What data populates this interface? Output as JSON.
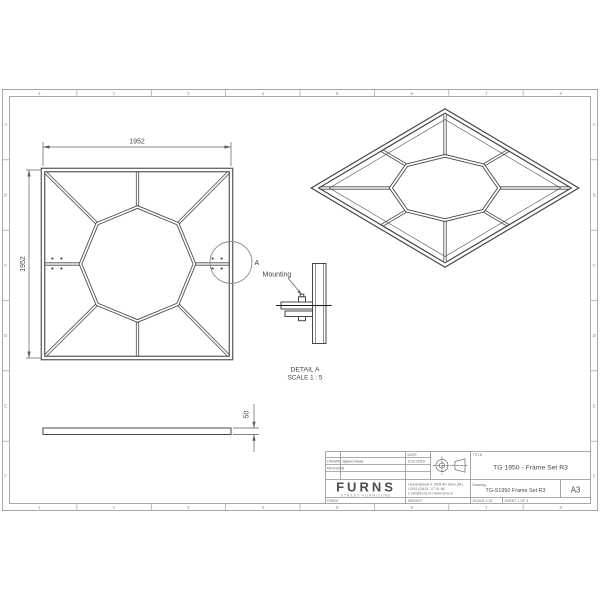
{
  "sheet": {
    "zone_columns": [
      "1",
      "2",
      "3",
      "4",
      "5",
      "6",
      "7",
      "8"
    ],
    "zone_rows": [
      "A",
      "B",
      "C",
      "D",
      "E",
      "F"
    ]
  },
  "front_view": {
    "width_dim": "1952",
    "height_dim": "1952",
    "detail_callout": "A"
  },
  "side_view": {
    "thickness_dim": "50"
  },
  "detail_view": {
    "mounting_label": "Mounting",
    "name": "DETAIL A",
    "scale": "SCALE 1 : 5"
  },
  "title_block": {
    "drawn_label": "DRAWN",
    "drawn_by": "Sjoerd Haas",
    "revision_label": "REVISION",
    "date_label": "DATE",
    "date_value": "3-12-2019",
    "title_label": "TITLE",
    "title_value": "TG 1950 - Frame Set R3",
    "logo_text": "FURNS",
    "logo_tagline": "STREET FURNITURE",
    "address_line1": "Liessentstraat 4, 5405 AD Uden (NL)",
    "address_line2": "t 0031 (0)413 - 27 41 68.",
    "address_line3": "e info@furns.nl / www.furns.nl",
    "drawing_label": "Drawing.",
    "drawing_number": "TG-S1950 Frame Set R3",
    "paper_size": "A3",
    "finish_label": "FINISH",
    "weight_label": "WEIGHT:",
    "scale_value": "SCALE:1:15",
    "sheet_value": "SHEET 1 OF 4"
  }
}
